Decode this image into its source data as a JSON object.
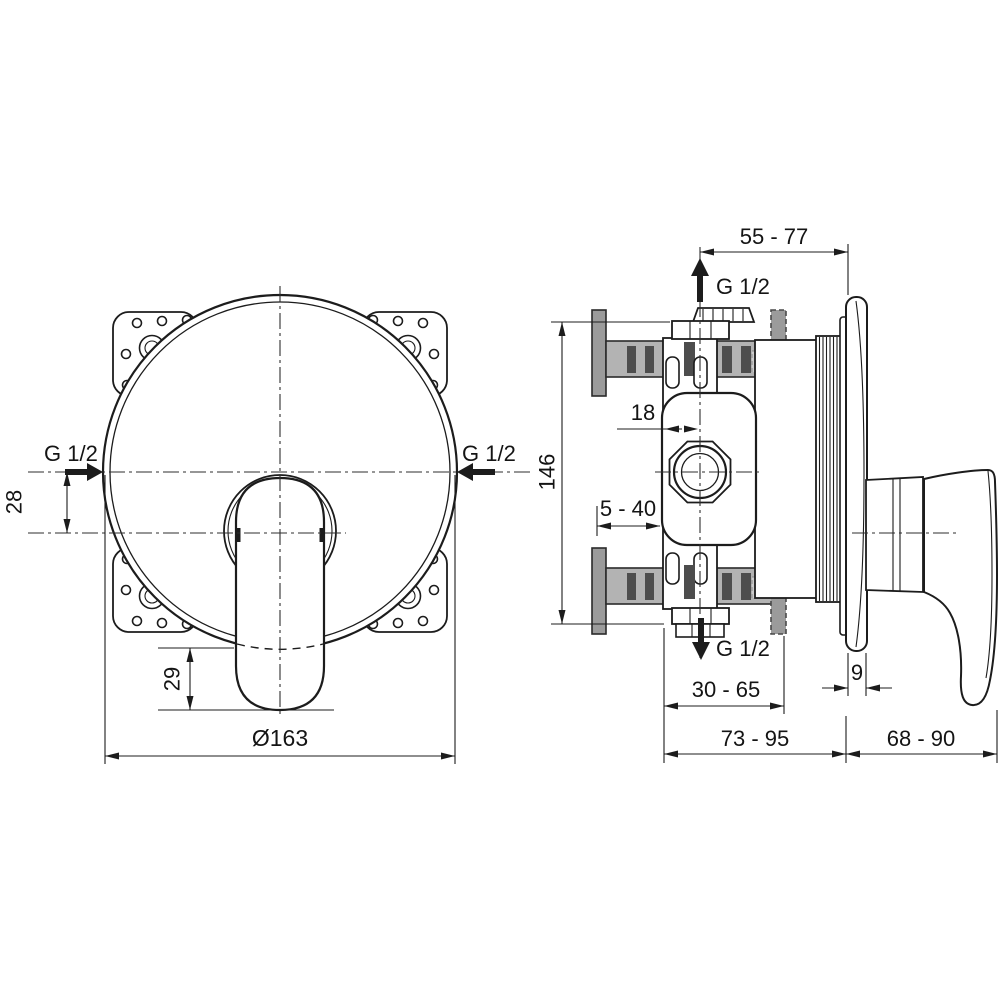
{
  "drawing": {
    "front_view": {
      "inlet_left_label": "G 1/2",
      "inlet_right_label": "G 1/2",
      "dim_inlet_offset": "28",
      "dim_lever_length": "29",
      "dim_diameter": "Ø163"
    },
    "side_view": {
      "dim_top_depth_range": "55 - 77",
      "outlet_top_label": "G 1/2",
      "dim_axis_offset": "18",
      "dim_height": "146",
      "dim_plaster_depth_range": "5 - 40",
      "outlet_bottom_label": "G 1/2",
      "dim_body_depth_range": "30 - 65",
      "dim_plate_thickness": "9",
      "dim_wall_depth_range": "73 - 95",
      "dim_projection_range": "68 - 90"
    },
    "colors": {
      "line": "#1c1c1c",
      "flange_gray": "#9b9b9b",
      "pipe_gray": "#b3b3b3",
      "dark_gray": "#4d4d4d",
      "patch_gray": "#cccccc"
    }
  }
}
